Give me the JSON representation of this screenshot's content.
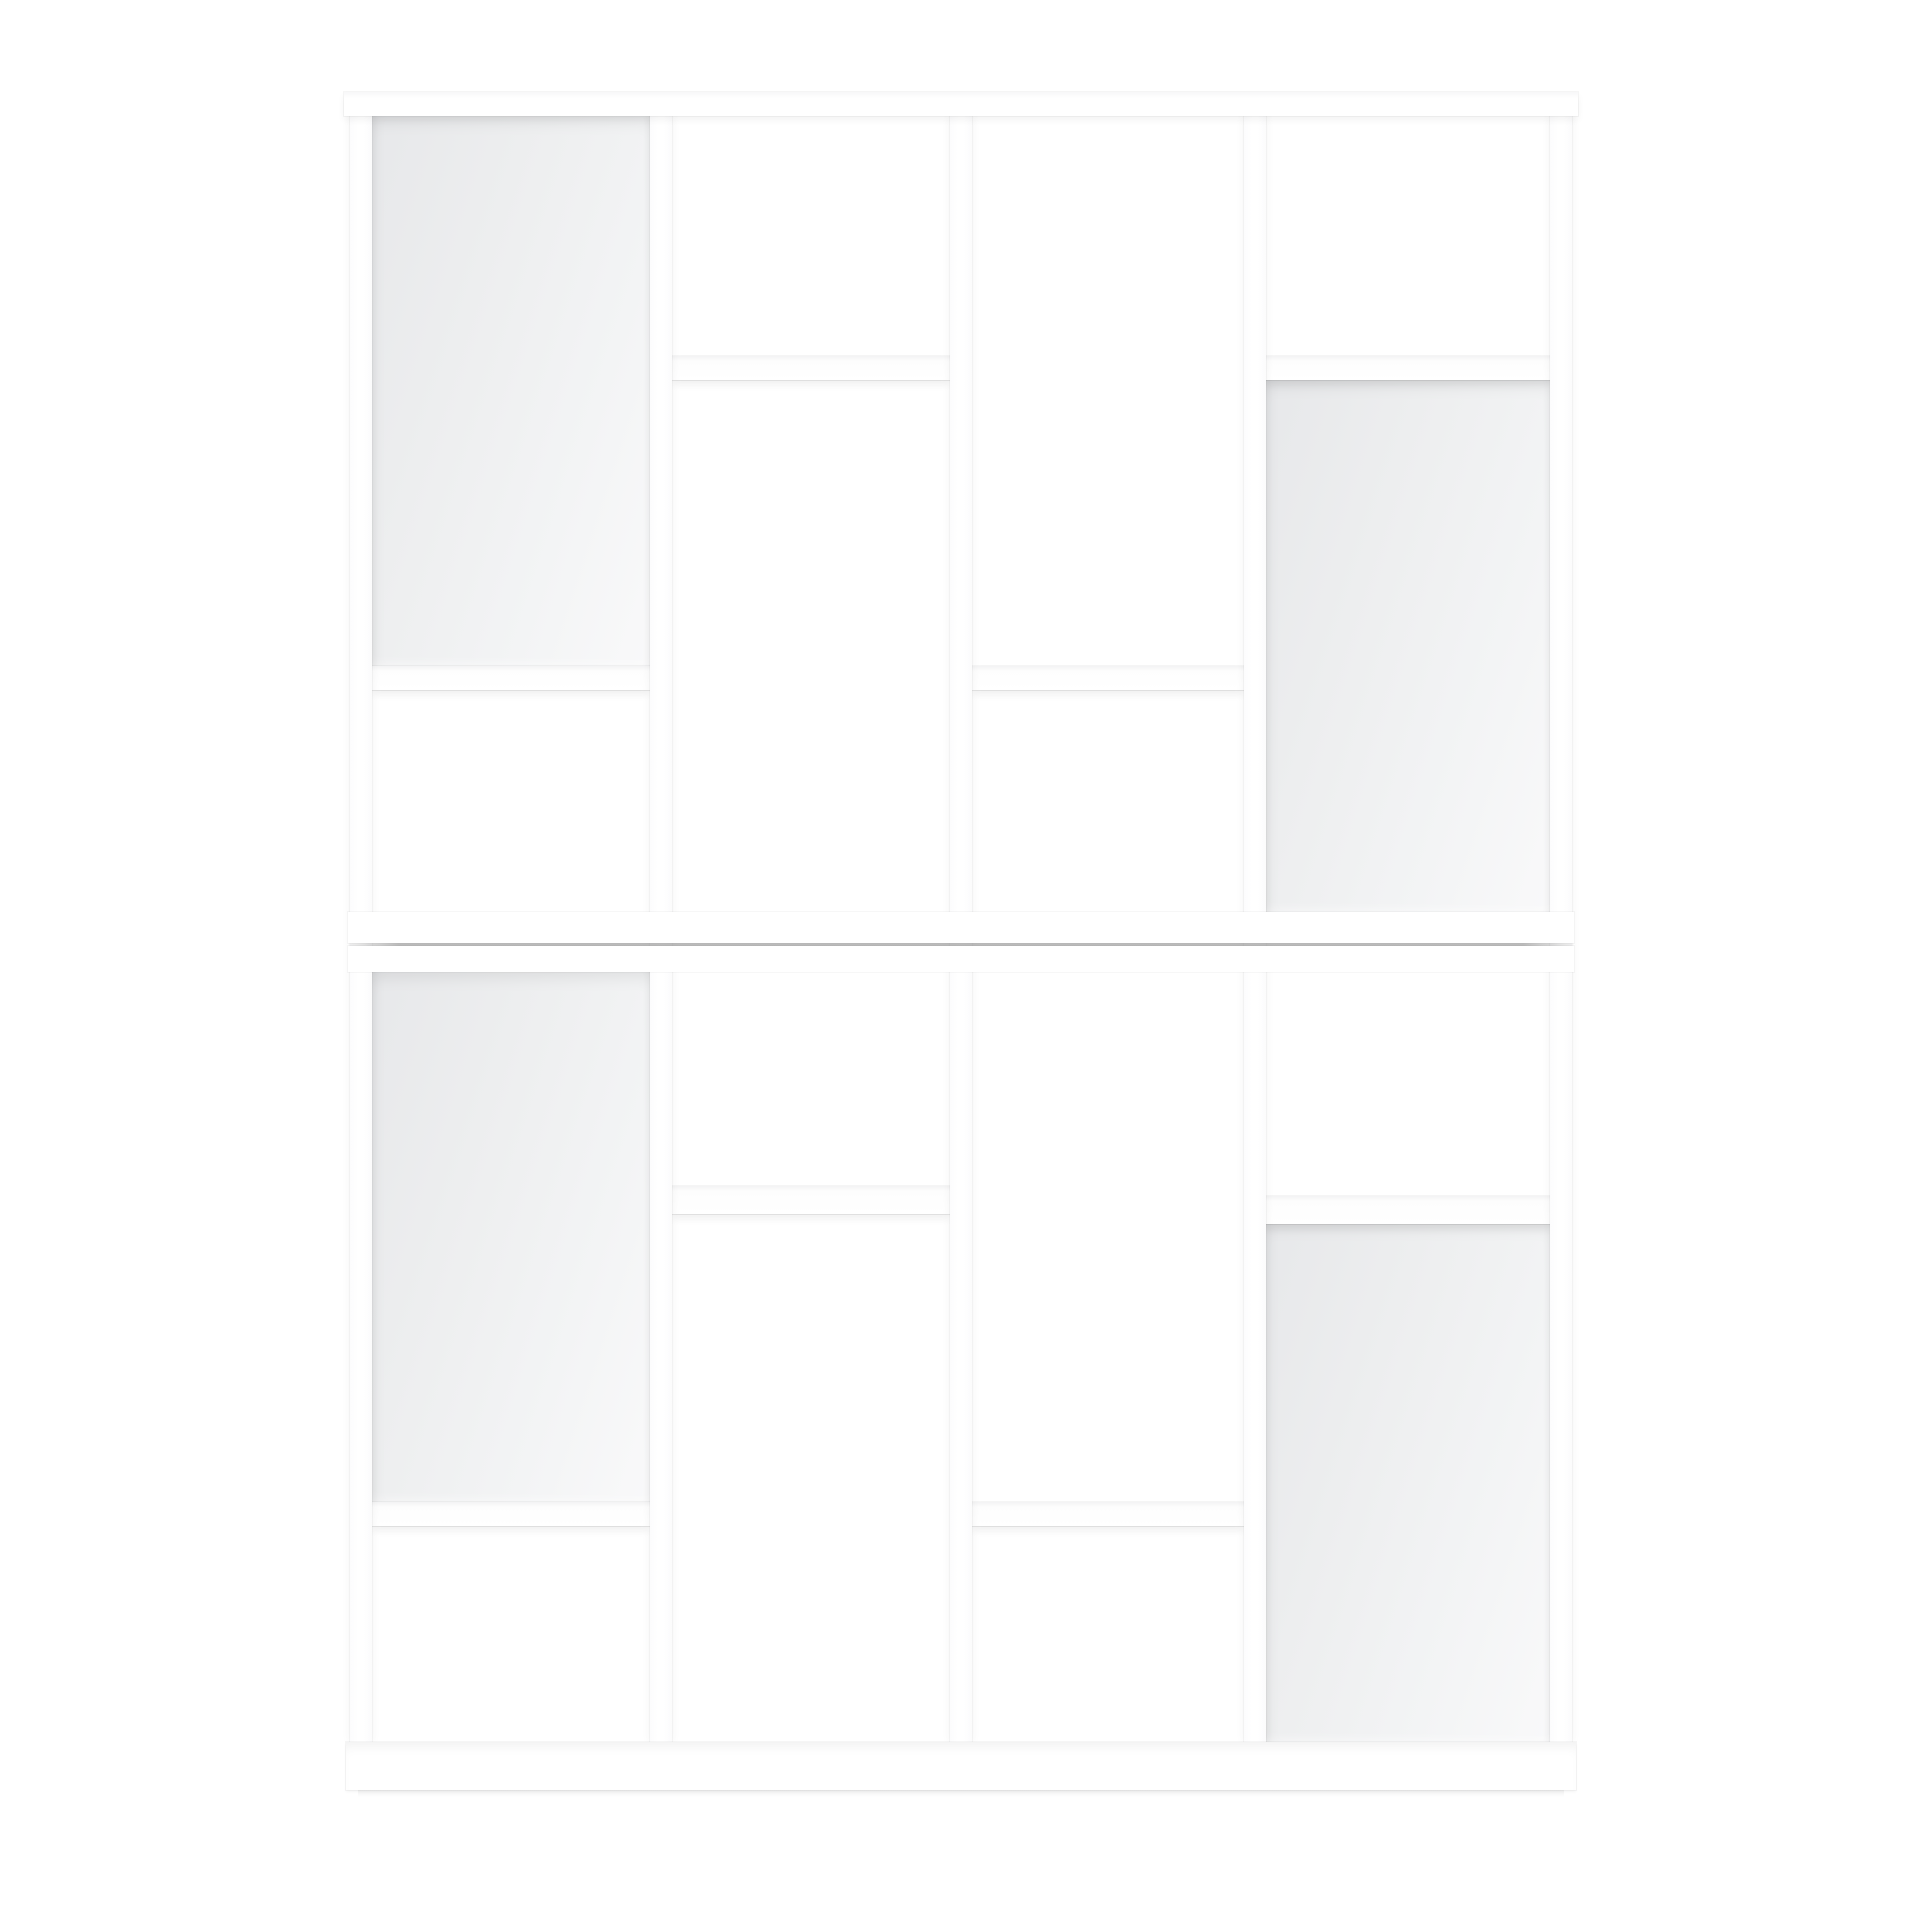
{
  "scene": {
    "canvas": {
      "width": 1920,
      "height": 1920,
      "background_color": "#ffffff"
    },
    "furniture_color": "#ffffff",
    "back_panel_color": "#ededee",
    "seam_color": "#969696",
    "members": [
      {
        "name": "back-panel-top-col1",
        "type": "panel",
        "x": 372,
        "y": 116,
        "w": 278,
        "h": 550
      },
      {
        "name": "back-panel-top-col4",
        "type": "panel",
        "x": 1266,
        "y": 380,
        "w": 284,
        "h": 532
      },
      {
        "name": "back-panel-bottom-col1",
        "type": "panel",
        "x": 372,
        "y": 972,
        "w": 278,
        "h": 530
      },
      {
        "name": "back-panel-bottom-col4",
        "type": "panel",
        "x": 1266,
        "y": 1222,
        "w": 284,
        "h": 520
      },
      {
        "name": "shelf-top-col1",
        "type": "shelf",
        "x": 372,
        "y": 666,
        "w": 278,
        "h": 24
      },
      {
        "name": "shelf-top-col2",
        "type": "shelf",
        "x": 672,
        "y": 356,
        "w": 278,
        "h": 24
      },
      {
        "name": "shelf-top-col3",
        "type": "shelf",
        "x": 972,
        "y": 666,
        "w": 272,
        "h": 24
      },
      {
        "name": "shelf-top-col4",
        "type": "shelf",
        "x": 1266,
        "y": 356,
        "w": 284,
        "h": 24
      },
      {
        "name": "shelf-bottom-col1",
        "type": "shelf",
        "x": 372,
        "y": 1502,
        "w": 278,
        "h": 24
      },
      {
        "name": "shelf-bottom-col2",
        "type": "shelf",
        "x": 672,
        "y": 1186,
        "w": 278,
        "h": 28
      },
      {
        "name": "shelf-bottom-col3",
        "type": "shelf",
        "x": 972,
        "y": 1502,
        "w": 272,
        "h": 24
      },
      {
        "name": "shelf-bottom-col4",
        "type": "shelf",
        "x": 1266,
        "y": 1196,
        "w": 284,
        "h": 28
      },
      {
        "name": "upright-left",
        "type": "upright",
        "x": 350,
        "y": 116,
        "w": 22,
        "h": 1626
      },
      {
        "name": "upright-2",
        "type": "upright",
        "x": 650,
        "y": 116,
        "w": 22,
        "h": 1626
      },
      {
        "name": "upright-3",
        "type": "upright",
        "x": 950,
        "y": 116,
        "w": 22,
        "h": 1626
      },
      {
        "name": "upright-4",
        "type": "upright",
        "x": 1244,
        "y": 116,
        "w": 22,
        "h": 1626
      },
      {
        "name": "upright-right",
        "type": "upright",
        "x": 1550,
        "y": 116,
        "w": 22,
        "h": 1626
      },
      {
        "name": "mid-rail-upper",
        "type": "rail",
        "x": 348,
        "y": 912,
        "w": 1226,
        "h": 31
      },
      {
        "name": "mid-unit-seam",
        "type": "seam",
        "x": 350,
        "y": 943,
        "w": 1222,
        "h": 3
      },
      {
        "name": "mid-rail-lower",
        "type": "rail",
        "x": 348,
        "y": 946,
        "w": 1226,
        "h": 26
      },
      {
        "name": "top-board",
        "type": "board",
        "x": 344,
        "y": 92,
        "w": 1234,
        "h": 24
      },
      {
        "name": "plinth-board",
        "type": "plinth",
        "x": 346,
        "y": 1742,
        "w": 1230,
        "h": 48
      },
      {
        "name": "floor-shadow",
        "type": "floor-shadow",
        "x": 358,
        "y": 1790,
        "w": 1206,
        "h": 7
      }
    ]
  }
}
